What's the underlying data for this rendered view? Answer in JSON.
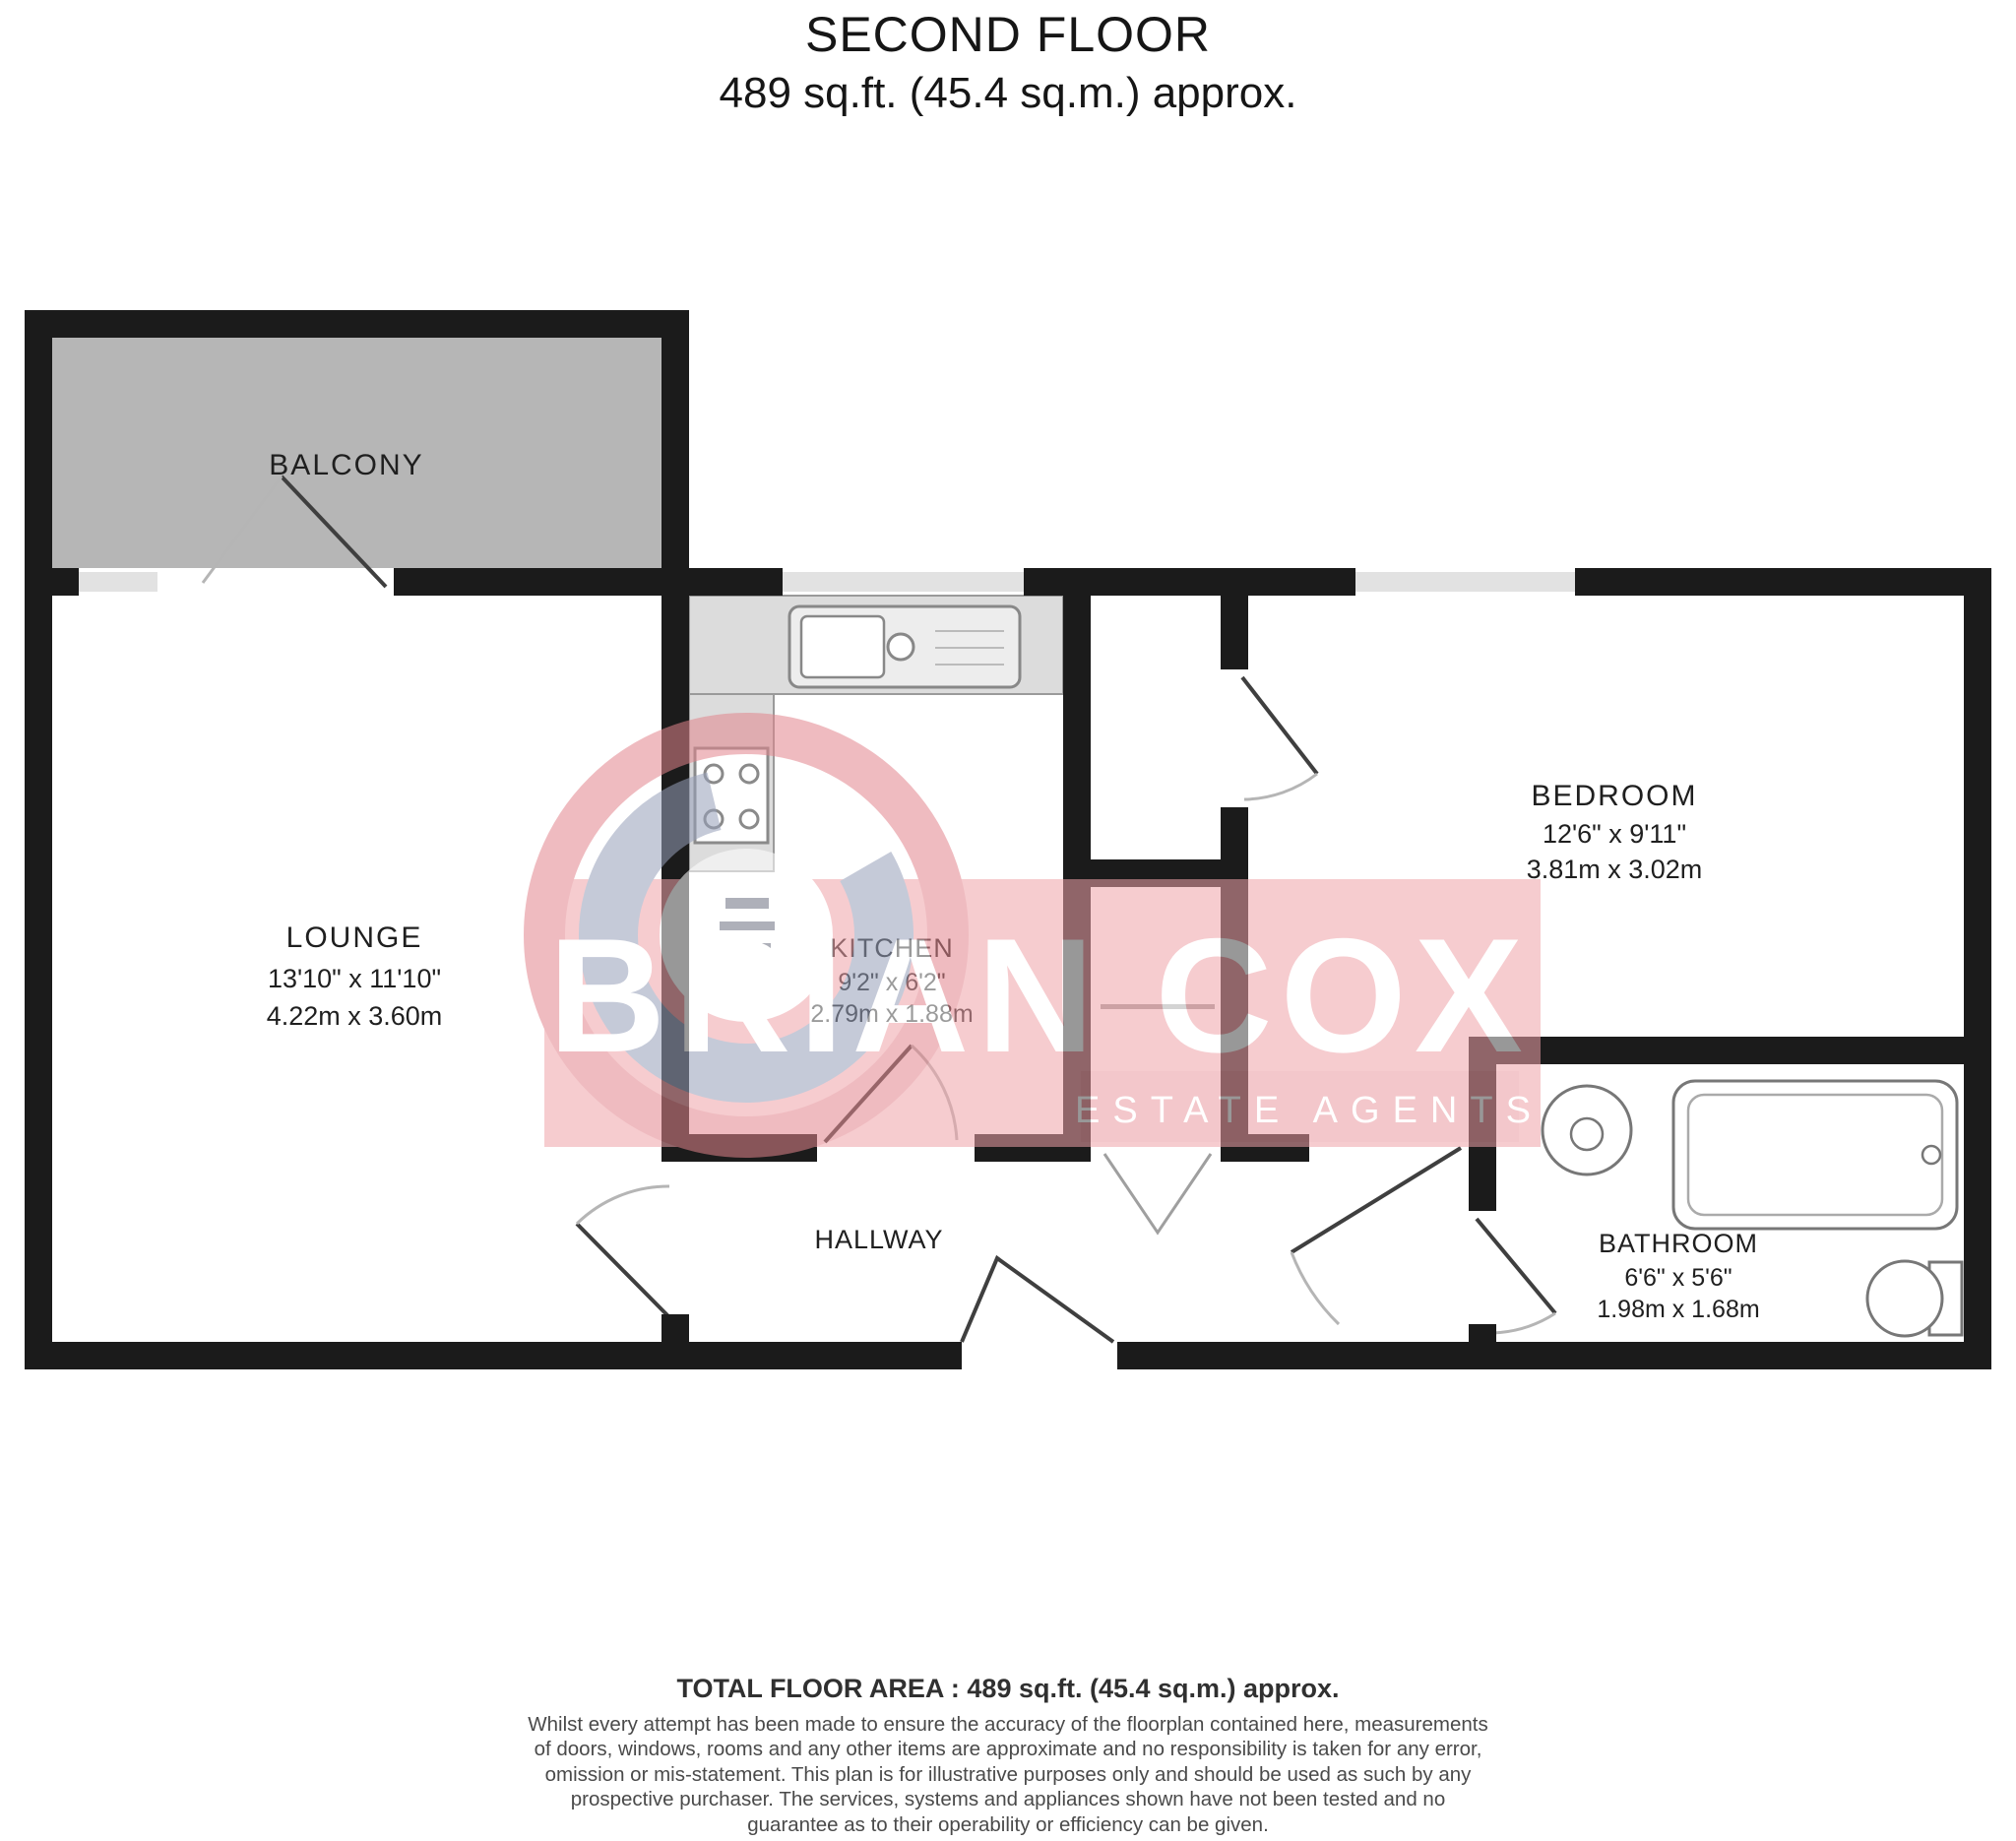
{
  "title": {
    "line1": "SECOND FLOOR",
    "line2": "489 sq.ft. (45.4 sq.m.) approx."
  },
  "rooms": {
    "balcony": {
      "name": "BALCONY"
    },
    "lounge": {
      "name": "LOUNGE",
      "imperial": "13'10\" x 11'10\"",
      "metric": "4.22m x 3.60m"
    },
    "kitchen": {
      "name": "KITCHEN",
      "imperial": "9'2\" x 6'2\"",
      "metric": "2.79m x 1.88m"
    },
    "bedroom": {
      "name": "BEDROOM",
      "imperial": "12'6\" x 9'11\"",
      "metric": "3.81m x 3.02m"
    },
    "bathroom": {
      "name": "BATHROOM",
      "imperial": "6'6\" x 5'6\"",
      "metric": "1.98m x 1.68m"
    },
    "hallway": {
      "name": "HALLWAY"
    }
  },
  "watermark": {
    "brand": "BRIAN COX",
    "tagline": "ESTATE AGENTS"
  },
  "footer": {
    "total": "TOTAL FLOOR AREA : 489 sq.ft. (45.4 sq.m.) approx.",
    "disclaimer": "Whilst every attempt has been made to ensure the accuracy of the floorplan contained here, measurements of doors, windows, rooms and any other items are approximate and no responsibility is taken for any error, omission or mis-statement. This plan is for illustrative purposes only and should be used as such by any prospective purchaser. The services, systems and appliances shown have not been tested and no guarantee as to their operability or efficiency can be given.",
    "credit": "Made with Metropix ©2021"
  },
  "colors": {
    "wall": "#1b1b1b",
    "balcony_fill": "#b6b6b6",
    "window": "#e2e2e2",
    "counter": "#dcdcdc",
    "watermark_band": "#f0a3a9",
    "watermark_ring_outer": "#e2858d",
    "watermark_ring_inner": "#97a0ba"
  }
}
